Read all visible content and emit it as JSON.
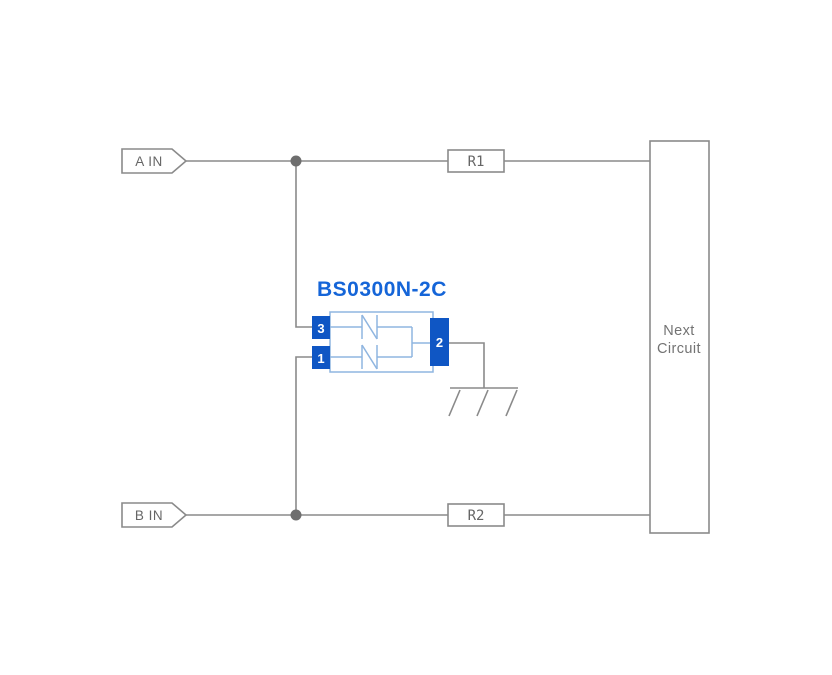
{
  "diagram": {
    "title": "BS0300N-2C",
    "inputs": {
      "a": "A IN",
      "b": "B IN"
    },
    "resistors": {
      "r1": "R1",
      "r2": "R2"
    },
    "component": {
      "title": "BS0300N-2C",
      "pin_top_left": "3",
      "pin_bottom_left": "1",
      "pin_right": "2"
    },
    "next_circuit": {
      "line1": "Next",
      "line2": "Circuit"
    }
  },
  "colors": {
    "background": "#ffffff",
    "wire": "#8a8a8a",
    "junction": "#6e6e6e",
    "label_text": "#666666",
    "next_text": "#737373",
    "component_title": "#1565d8",
    "component_border": "#8fb5e0",
    "pin_fill": "#0f56c4",
    "pin_text": "#ffffff"
  }
}
